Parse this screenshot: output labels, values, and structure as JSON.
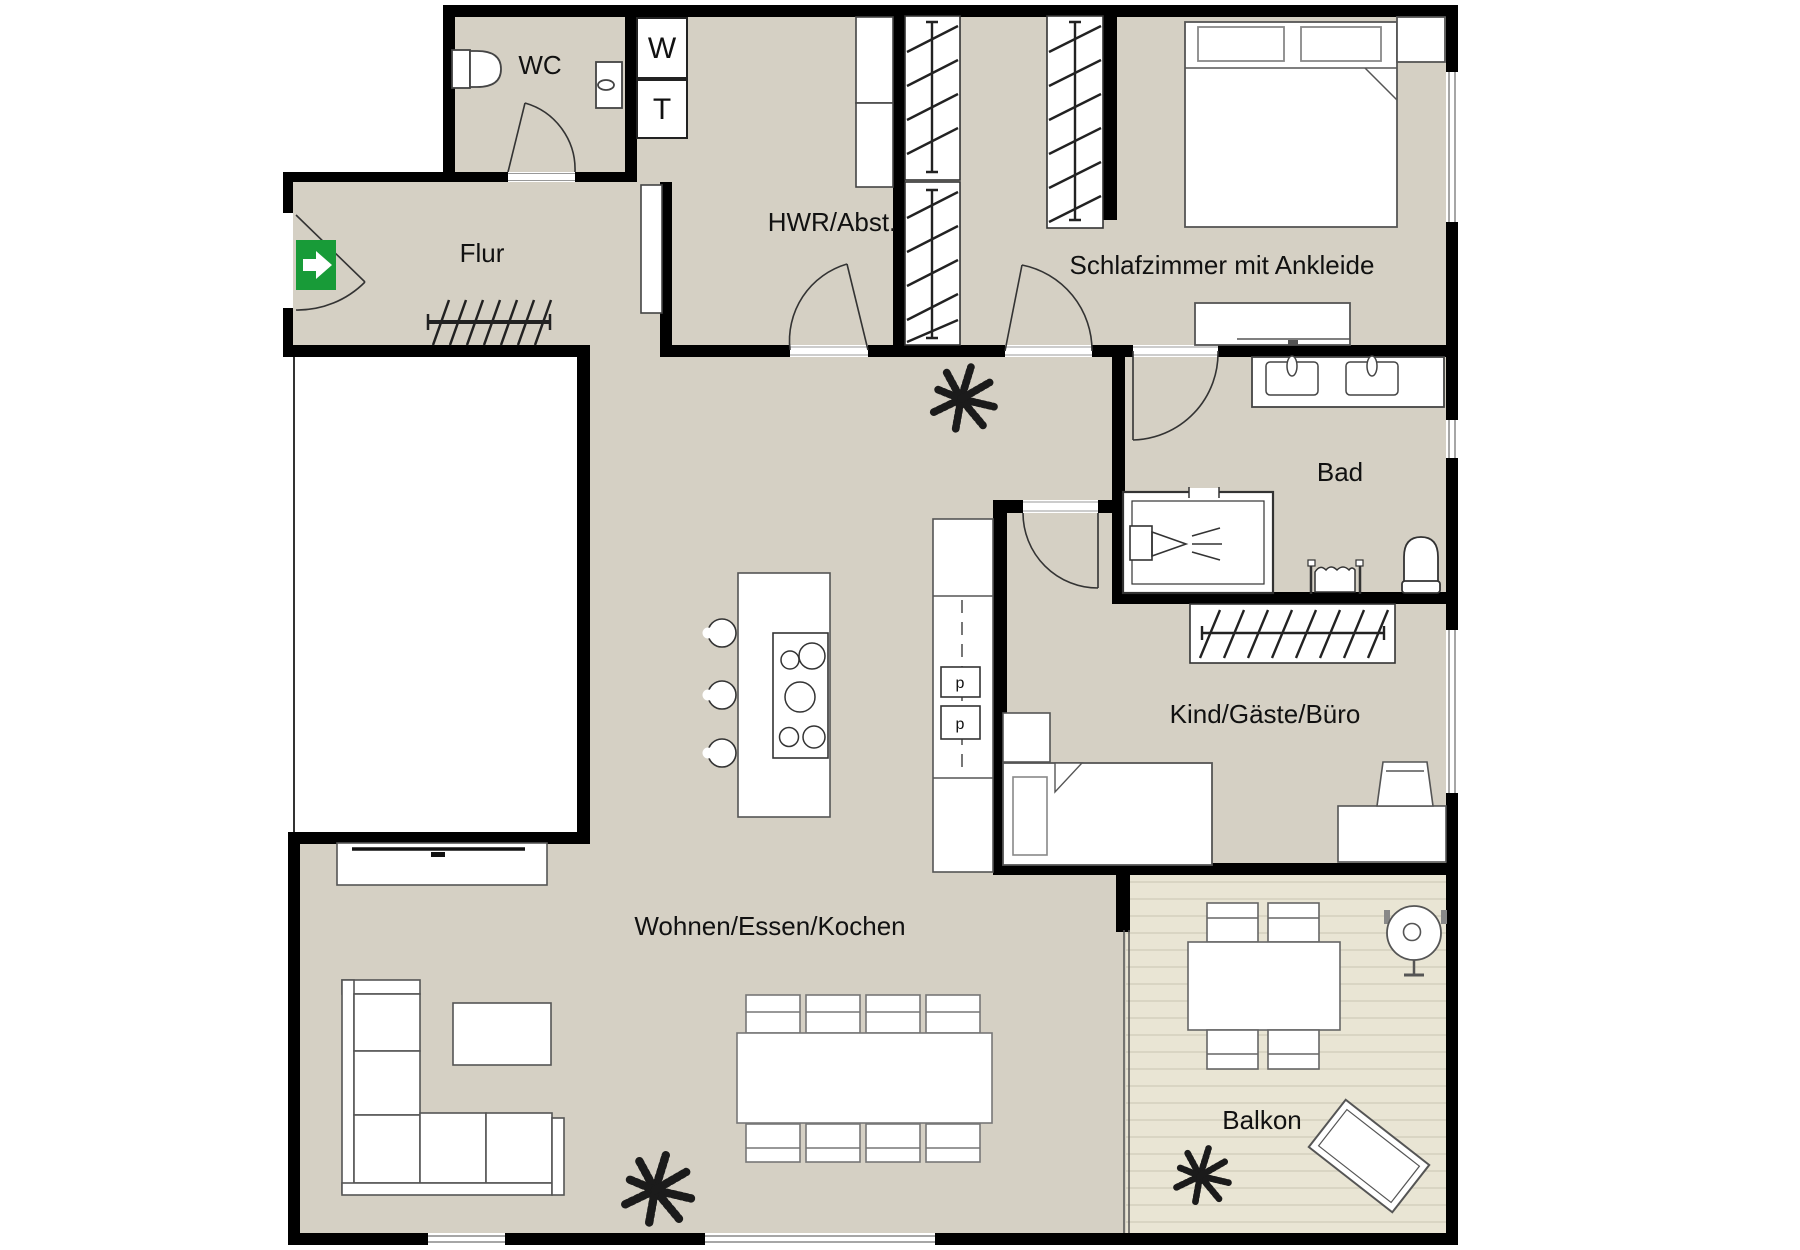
{
  "plan": {
    "type": "apartment-floor-plan",
    "colors": {
      "floor": "#d5d0c4",
      "balcony_floor": "#e9e5d4",
      "deck_line": "#d9d5c3",
      "wall": "#000000",
      "exit_sign_green": "#189b38",
      "furniture_stroke": "#555555"
    },
    "rooms": {
      "flur": {
        "label": "Flur"
      },
      "wc": {
        "label": "WC"
      },
      "hwr": {
        "label": "HWR/Abst."
      },
      "schlafzimmer": {
        "label": "Schlafzimmer mit Ankleide"
      },
      "bad": {
        "label": "Bad"
      },
      "kind": {
        "label": "Kind/Gäste/Büro"
      },
      "wohnen": {
        "label": "Wohnen/Essen/Kochen"
      },
      "balkon": {
        "label": "Balkon"
      }
    },
    "appliances": {
      "washer": "W",
      "dryer": "T",
      "appliance_upper": "p",
      "appliance_lower": "p"
    }
  }
}
